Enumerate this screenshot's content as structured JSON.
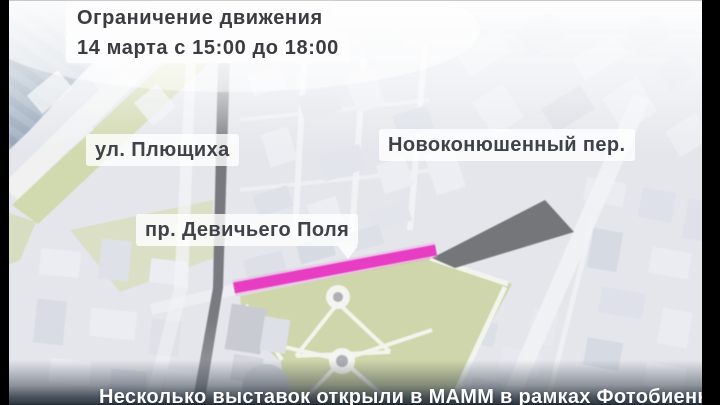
{
  "banner": {
    "title": "Ограничение движения",
    "subtitle": "14 марта с 15:00 до 18:00"
  },
  "street_labels": {
    "plyushchikha": "ул. Плющиха",
    "novokonyushenny": "Новоконюшенный пер.",
    "devichyego_polya": "пр. Девичьего Поля"
  },
  "ticker": {
    "text": "Несколько выставок открыли в МАММ в рамках Фотобиеннале"
  },
  "icons": {
    "label_pointer": "triangle-down-icon"
  },
  "colors": {
    "highlight_magenta": "#e318b8",
    "road_dark": "#5a5c61",
    "park_green": "#c6cf9b",
    "water_blue": "#8ea0b5",
    "label_background": "#ffffff",
    "label_text": "#3a3c41",
    "ticker_band": "#28323e"
  }
}
